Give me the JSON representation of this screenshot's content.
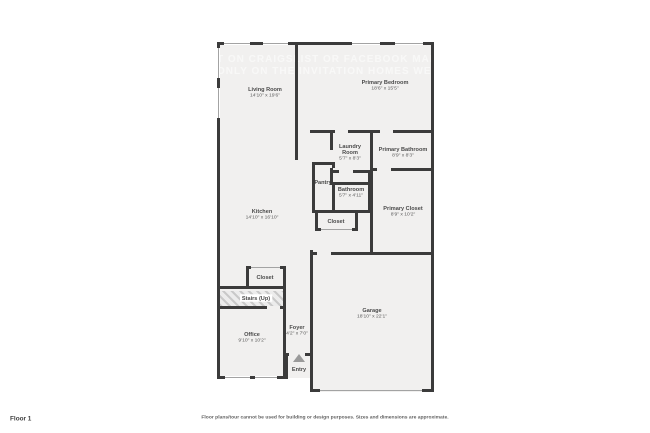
{
  "colors": {
    "wall": "#3b3b3b",
    "floor_fill": "#f1f0ef",
    "window_line": "#a3a3a3",
    "label_text": "#4a4a4a",
    "watermark_text": "#ffffff",
    "page_bg": "#ffffff"
  },
  "floor_label": "Floor 1",
  "disclaimer": "Floor plans/tour cannot be used for building or design purposes. Sizes and dimensions are approximate.",
  "watermark": {
    "line1": "T ON CRAIGSLIST OR FACEBOOK MARK",
    "line2": "ONLY ON THE INVITATION HOMES WEB"
  },
  "rooms": [
    {
      "id": "living-room",
      "name": "Living Room",
      "dims": "14'10\" x 19'6\""
    },
    {
      "id": "primary-bedroom",
      "name": "Primary Bedroom",
      "dims": "18'6\" x 15'5\""
    },
    {
      "id": "laundry-room",
      "name": "Laundry Room",
      "dims": "5'7\" x 8'3\""
    },
    {
      "id": "primary-bathroom",
      "name": "Primary Bathroom",
      "dims": "8'9\" x 8'3\""
    },
    {
      "id": "pantry",
      "name": "Pantry",
      "dims": ""
    },
    {
      "id": "bathroom",
      "name": "Bathroom",
      "dims": "5'7\" x 4'11\""
    },
    {
      "id": "primary-closet",
      "name": "Primary Closet",
      "dims": "8'9\" x 10'2\""
    },
    {
      "id": "closet-hall",
      "name": "Closet",
      "dims": ""
    },
    {
      "id": "kitchen",
      "name": "Kitchen",
      "dims": "14'10\" x 16'10\""
    },
    {
      "id": "closet-stairs",
      "name": "Closet",
      "dims": ""
    },
    {
      "id": "stairs",
      "name": "Stairs (Up)",
      "dims": ""
    },
    {
      "id": "office",
      "name": "Office",
      "dims": "9'10\" x 10'2\""
    },
    {
      "id": "foyer",
      "name": "Foyer",
      "dims": "4'2\" x 7'0\""
    },
    {
      "id": "entry",
      "name": "Entry",
      "dims": ""
    },
    {
      "id": "garage",
      "name": "Garage",
      "dims": "18'10\" x 22'1\""
    }
  ]
}
